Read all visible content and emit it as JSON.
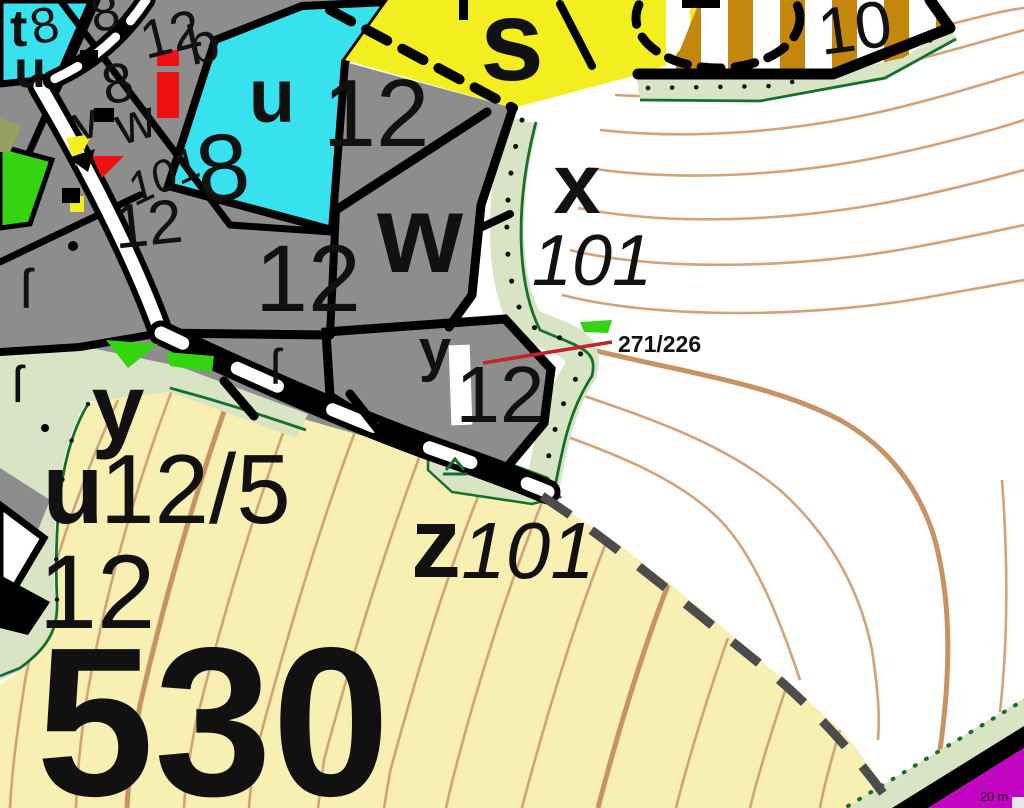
{
  "map": {
    "cluster_labels": {
      "t": "t",
      "eight_a": "8",
      "u": "u",
      "eight_b": "8",
      "twelve_a": "12",
      "b": "b",
      "eight_c": "8",
      "v": "v",
      "w": "w",
      "parcel_101": "101",
      "eight_d": "8",
      "twelve_b": "12"
    },
    "parcel_labels": {
      "u_cyan": "u",
      "twelve_top": "12",
      "s": "s",
      "ten": "10",
      "twelve_big": "12",
      "w": "w",
      "x": "x",
      "x_num": "101",
      "y_mid": "y",
      "twelve_mid": "12",
      "y_big": "y",
      "u_beige": "u",
      "u_beige_num": "12/5",
      "twelve_bottom": "12",
      "stand_530": "530",
      "z": "z",
      "z_num": "101"
    },
    "annotation": {
      "ref": "271/226"
    },
    "scale": {
      "label": "20 m"
    },
    "symbols": {
      "hook": "ſ"
    },
    "colors": {
      "beige": "#f8efb2",
      "gray": "#8d8d8d",
      "cyan": "#38e1ee",
      "yellow": "#f2ee20",
      "gold": "#c5860e",
      "sage": "#d8e4c4",
      "dark_green": "#15702c",
      "bright_green": "#35d411",
      "contour": "#d2a27a",
      "contour_index": "#c89363",
      "magenta": "#c203c2",
      "annotation_red": "#9c1c29",
      "dash_gray": "#4c4c4c"
    }
  }
}
